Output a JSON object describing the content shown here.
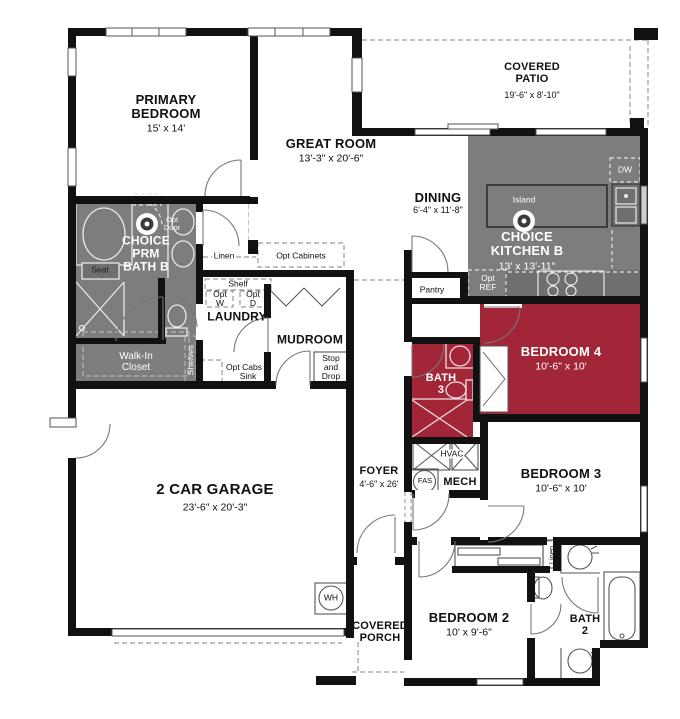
{
  "plan_title": "Single-story floor plan",
  "colors": {
    "wall": "#111111",
    "option_gray": "#7d7d7d",
    "option_red": "#a32638",
    "counter_gray": "#6f6f6f",
    "fixture_light": "#ebebeb",
    "fixture_dark": "#555555",
    "dash": "#999999"
  },
  "rooms": {
    "primary": {
      "name": "PRIMARY BEDROOM",
      "dims": "15' x 14'"
    },
    "great": {
      "name": "GREAT ROOM",
      "dims": "13'-3\" x 20'-6\""
    },
    "patio": {
      "name": "COVERED PATIO",
      "dims": "19'-6\" x 8'-10\""
    },
    "dining": {
      "name": "DINING",
      "dims": "6'-4\" x 11'-8\""
    },
    "kitchen": {
      "name": "CHOICE KITCHEN B",
      "dims": "13' x 13'-11\""
    },
    "prm_bath": {
      "name": "CHOICE PRM BATH B"
    },
    "laundry": {
      "name": "LAUNDRY"
    },
    "mudroom": {
      "name": "MUDROOM"
    },
    "closet": {
      "name": "Walk-In Closet"
    },
    "pantry": {
      "name": "Pantry"
    },
    "bed4": {
      "name": "BEDROOM 4",
      "dims": "10'-6\" x 10'"
    },
    "bath3": {
      "name": "BATH 3"
    },
    "bed3": {
      "name": "BEDROOM 3",
      "dims": "10'-6\" x 10'"
    },
    "mech": {
      "name": "MECH"
    },
    "foyer": {
      "name": "FOYER",
      "dims": "4'-6\" x 26'"
    },
    "garage": {
      "name": "2 CAR GARAGE",
      "dims": "23'-6\" x 20'-3\""
    },
    "porch": {
      "name": "COVERED PORCH"
    },
    "bed2": {
      "name": "BEDROOM 2",
      "dims": "10' x 9'-6\""
    },
    "bath2": {
      "name": "BATH 2"
    }
  },
  "labels": {
    "opt_door": "Opt Door",
    "seat": "Seat",
    "linen": "Linen",
    "linen_2": "Linen",
    "opt_cabinets": "Opt Cabinets",
    "shelf": "Shelf",
    "opt_w": "Opt W",
    "opt_d": "Opt D",
    "shelves": "Shelves",
    "opt_cabs_sink": "Opt Cabs & Sink",
    "stop_and_drop": "Stop and Drop",
    "island": "Island",
    "dw": "DW",
    "opt_ref": "Opt REF",
    "hvac": "HVAC",
    "fas": "FAS",
    "wh": "WH"
  }
}
